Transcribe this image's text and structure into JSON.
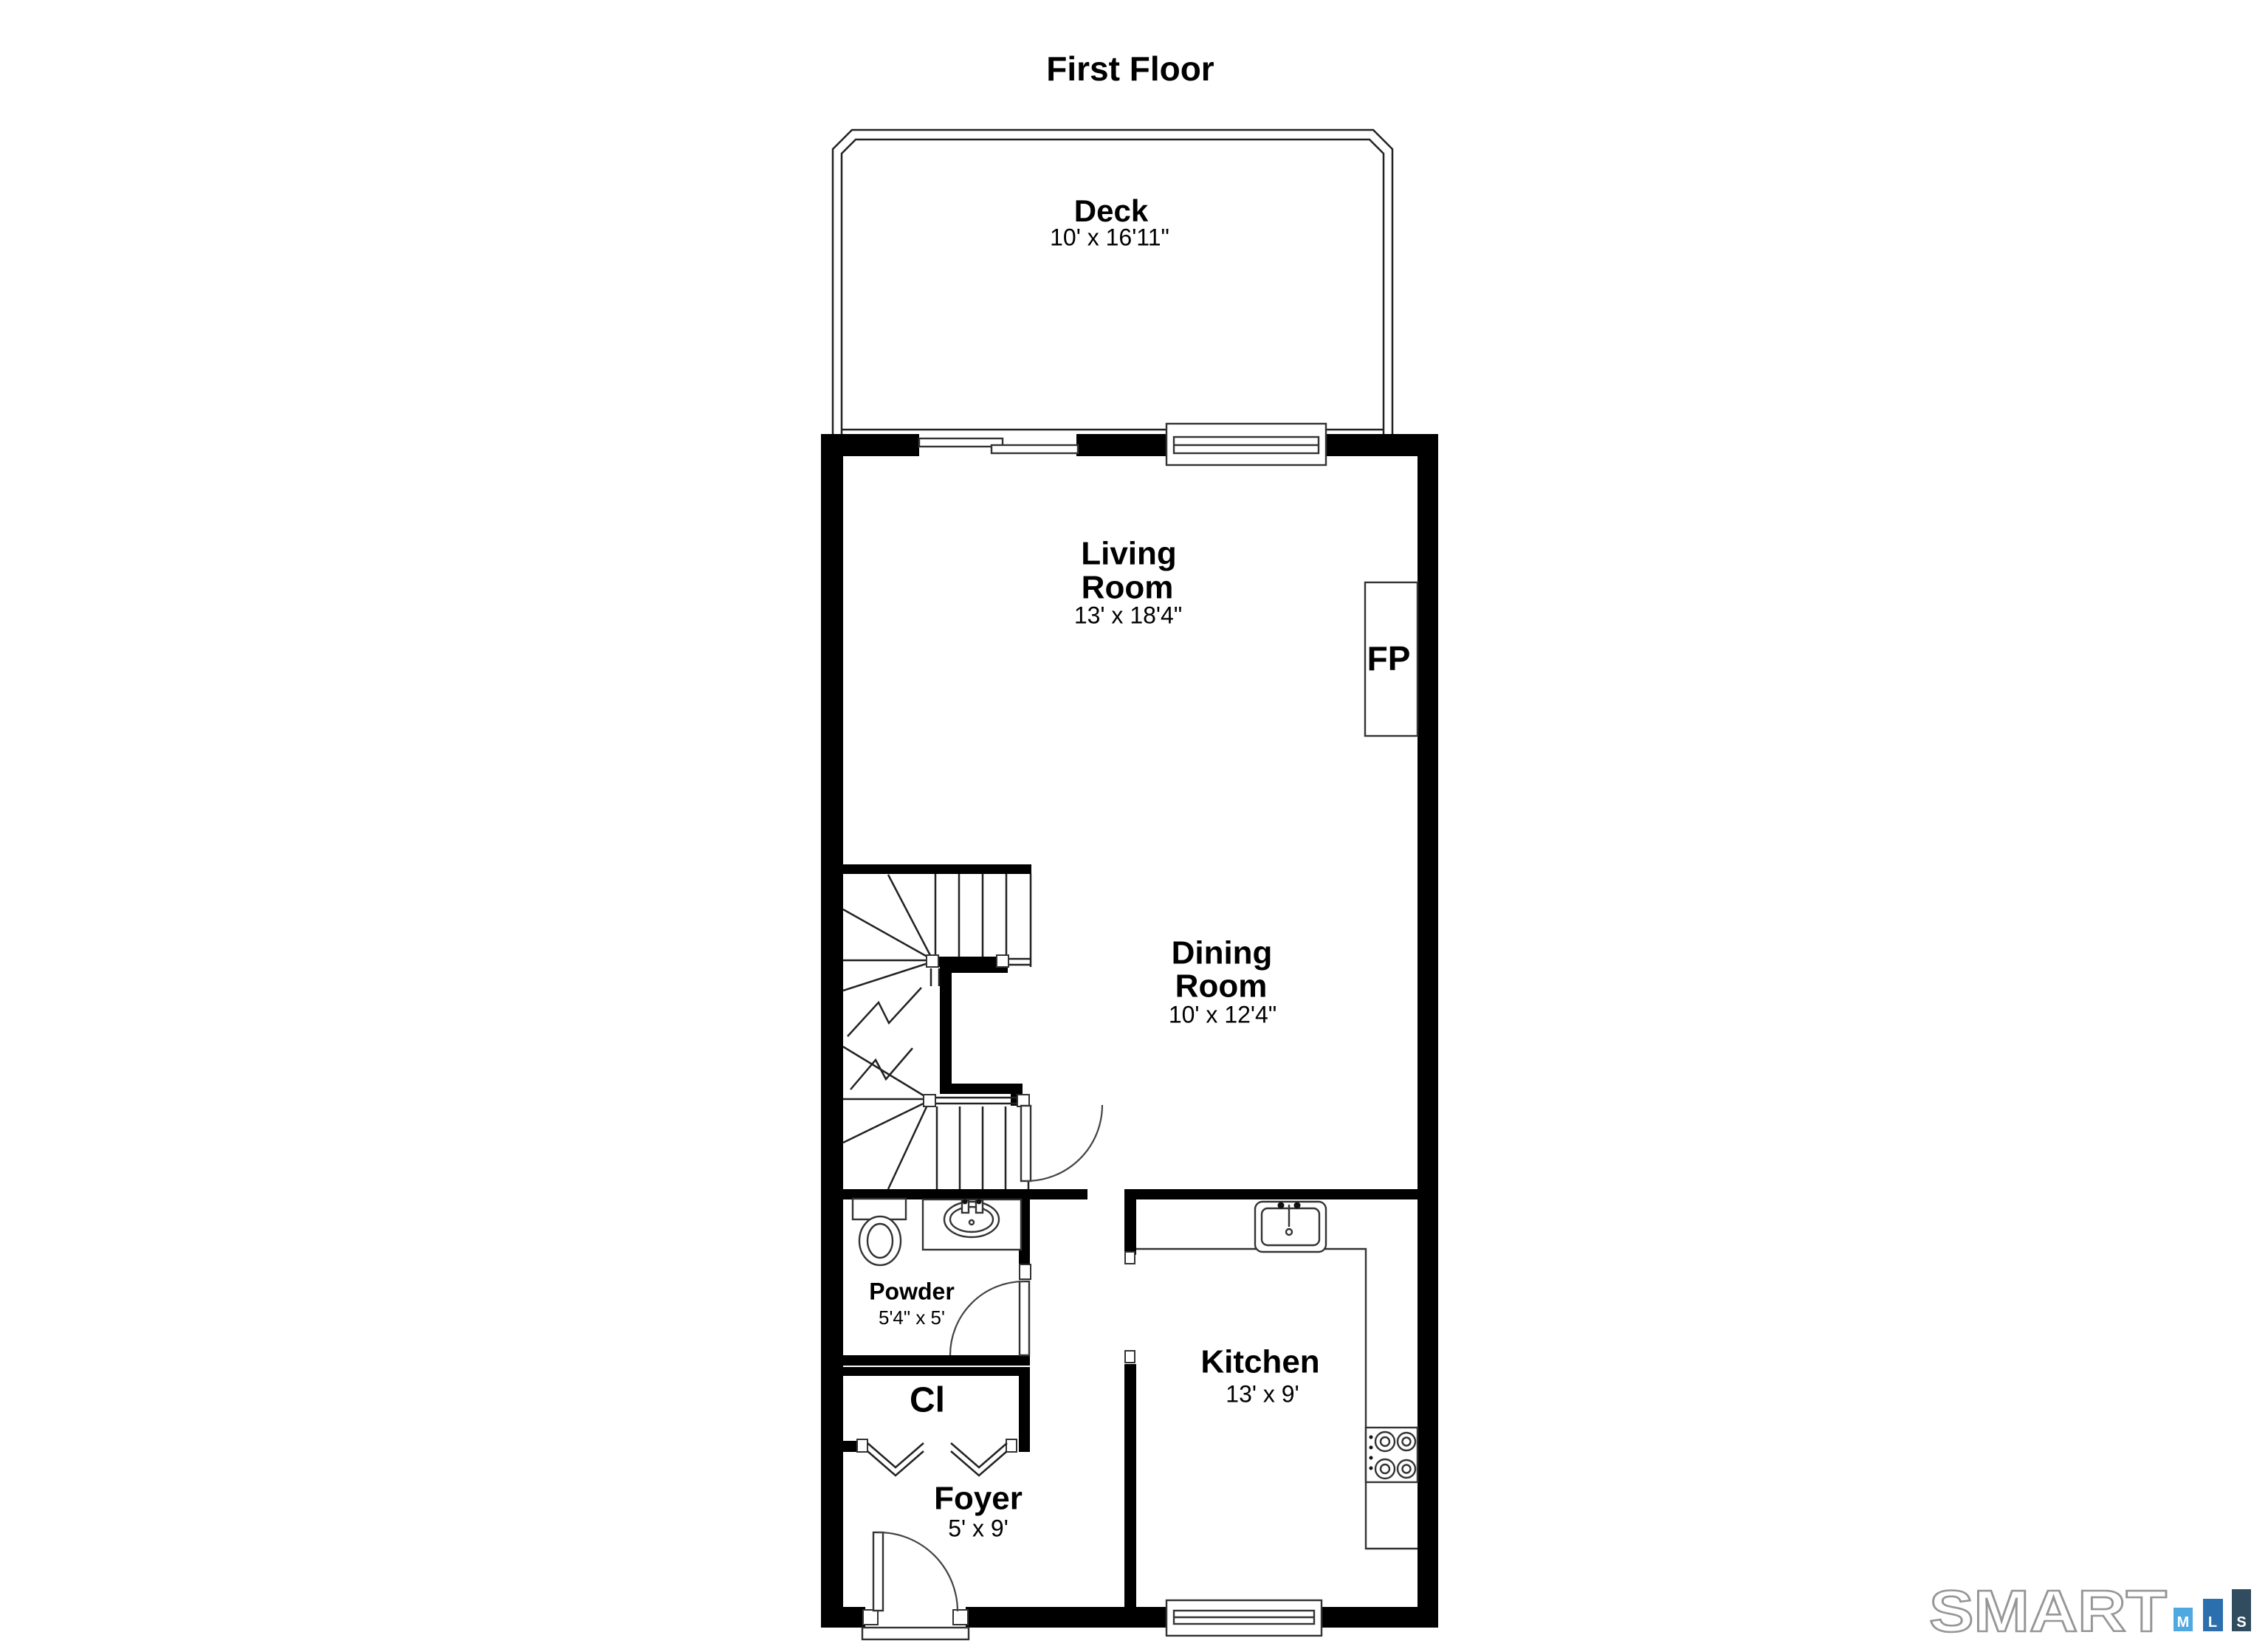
{
  "page": {
    "title": "First Floor"
  },
  "rooms": {
    "deck": {
      "name": "Deck",
      "dims": "10' x 16'11\""
    },
    "living_room": {
      "name_line1": "Living",
      "name_line2": "Room",
      "dims": "13' x 18'4\""
    },
    "dining_room": {
      "name_line1": "Dining",
      "name_line2": "Room",
      "dims": "10' x 12'4\""
    },
    "kitchen": {
      "name": "Kitchen",
      "dims": "13' x 9'"
    },
    "powder_room": {
      "name": "Powder",
      "dims": "5'4\" x 5'"
    },
    "closet": {
      "abbr": "Cl"
    },
    "foyer": {
      "name": "Foyer",
      "dims": "5' x 9'"
    }
  },
  "annotations": {
    "fireplace_abbr": "FP"
  },
  "logo": {
    "word": "SMART",
    "outline_color": "#969696",
    "bars": [
      {
        "letter": "M",
        "color": "#4FA8DF"
      },
      {
        "letter": "L",
        "color": "#2C6FAE"
      },
      {
        "letter": "S",
        "color": "#304C5E"
      }
    ]
  },
  "colors": {
    "wall": "#000000",
    "background": "#ffffff"
  }
}
